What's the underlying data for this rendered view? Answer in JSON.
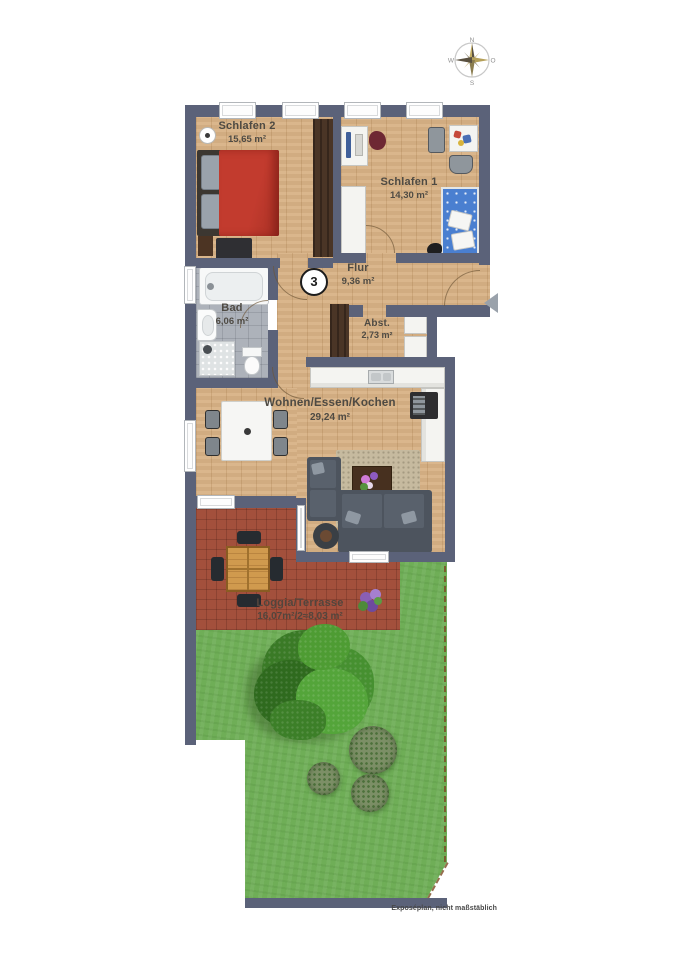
{
  "plan_title": "Wohnungsgrundriss",
  "unit_badge": "3",
  "compass": {
    "north": "N",
    "east": "O",
    "south": "S",
    "west": "W"
  },
  "rooms": {
    "schlafen2": {
      "name": "Schlafen 2",
      "area": "15,65 m²"
    },
    "schlafen1": {
      "name": "Schlafen 1",
      "area": "14,30 m²"
    },
    "flur": {
      "name": "Flur",
      "area": "9,36 m²"
    },
    "bad": {
      "name": "Bad",
      "area": "6,06 m²"
    },
    "abst": {
      "name": "Abst.",
      "area": "2,73 m²"
    },
    "wohnen": {
      "name": "Wohnen/Essen/Kochen",
      "area": "29,24 m²"
    },
    "loggia": {
      "name": "Loggia/Terrasse",
      "area": "16,07m²/2≈8,03 m²"
    }
  },
  "footer": {
    "note": "Exposéplan, nicht maßstäblich"
  },
  "icons": {
    "entrance_marker": "left-arrow",
    "compass_rose": "8-point-star"
  },
  "colors": {
    "wall": "#5b6279",
    "wood": "#d8b285",
    "tile": "#adb2ba",
    "brick": "#a3503c",
    "grass": "#6fae57",
    "bed_red": "#c23b2e",
    "bed_blue": "#4a7fd0",
    "boundary": "#7b4b22"
  }
}
